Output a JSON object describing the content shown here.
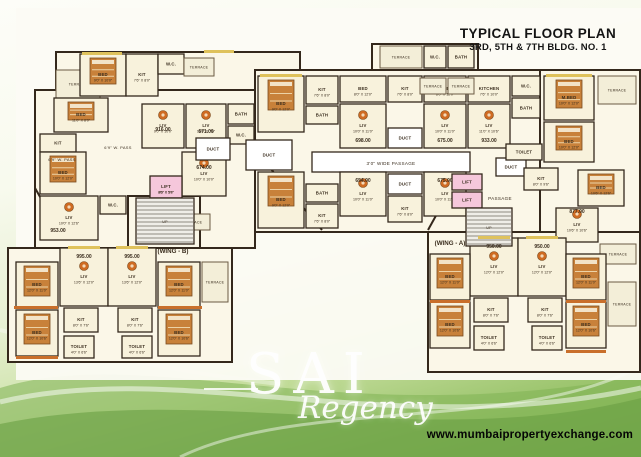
{
  "header": {
    "title": "TYPICAL FLOOR PLAN",
    "subtitle": "3RD, 5TH & 7TH BLDG. NO. 1"
  },
  "watermark": {
    "name": "SAI",
    "tagline": "Regency"
  },
  "footer": {
    "website": "www.mumbaipropertyexchange.com"
  },
  "plan": {
    "colors": {
      "wall": "#34281c",
      "paper": "#fbf7e8",
      "room": "#f8f2dc",
      "terrace": "#f3eed8",
      "terrace_stroke": "#6b5b43",
      "lift": "#f5c7db",
      "duct": "#ffffff",
      "stair": "#efede7",
      "stair_line": "#6f6a60",
      "bed_fill": "#c8813a",
      "bed_stroke": "#7a4a1e",
      "bed_line": "#ecd2a6",
      "table": "#cf6b22",
      "table_inner": "#f3d9b8",
      "sill_yellow": "#dfc25c",
      "sill_orange": "#c96f2b",
      "label": "#3a2d1e",
      "number": "#000000"
    },
    "blocks": [
      [
        56,
        52,
        244,
        98
      ],
      [
        35,
        90,
        220,
        158
      ],
      [
        255,
        70,
        385,
        162
      ],
      [
        540,
        70,
        100,
        178
      ],
      [
        372,
        44,
        106,
        26
      ],
      [
        8,
        248,
        224,
        114
      ],
      [
        428,
        232,
        212,
        140
      ],
      [
        128,
        196,
        72,
        52
      ]
    ],
    "diagonals": [
      [
        255,
        150,
        322,
        230
      ],
      [
        428,
        230,
        468,
        158
      ],
      [
        35,
        188,
        60,
        232
      ]
    ],
    "rooms": [
      {
        "x": 56,
        "y": 70,
        "w": 44,
        "h": 28,
        "t": "TERRACE",
        "f": "t"
      },
      {
        "x": 80,
        "y": 54,
        "w": 46,
        "h": 42,
        "t": "BED",
        "d": "9'0\" X 10'0\"",
        "fur": "bed"
      },
      {
        "x": 126,
        "y": 54,
        "w": 32,
        "h": 42,
        "t": "KIT",
        "d": "7'6\" X 8'0\""
      },
      {
        "x": 158,
        "y": 54,
        "w": 26,
        "h": 20,
        "t": "W.C."
      },
      {
        "x": 184,
        "y": 58,
        "w": 30,
        "h": 18,
        "t": "TERRACE",
        "f": "t"
      },
      {
        "x": 54,
        "y": 98,
        "w": 54,
        "h": 34,
        "t": "BED",
        "d": "11'0\" X 8'0\"",
        "fur": "bed"
      },
      {
        "x": 40,
        "y": 134,
        "w": 36,
        "h": 18,
        "t": "KIT"
      },
      {
        "x": 40,
        "y": 152,
        "w": 46,
        "h": 42,
        "t": "BED",
        "d": "10'0\" X 12'0\"",
        "fur": "bed"
      },
      {
        "x": 40,
        "y": 196,
        "w": 58,
        "h": 44,
        "t": "LIV",
        "d": "10'0\" X 12'6\"",
        "fur": "table"
      },
      {
        "x": 100,
        "y": 196,
        "w": 26,
        "h": 18,
        "t": "W.C."
      },
      {
        "x": 142,
        "y": 104,
        "w": 42,
        "h": 44,
        "t": "LIV",
        "d": "9'0\" X 10'0\"",
        "fur": "table"
      },
      {
        "x": 186,
        "y": 104,
        "w": 40,
        "h": 44,
        "t": "LIV",
        "d": "10'0\" X 7'6\"",
        "fur": "table"
      },
      {
        "x": 228,
        "y": 104,
        "w": 26,
        "h": 20,
        "t": "BATH"
      },
      {
        "x": 228,
        "y": 126,
        "w": 26,
        "h": 18,
        "t": "W.C."
      },
      {
        "x": 182,
        "y": 152,
        "w": 44,
        "h": 44,
        "t": "LIV",
        "d": "10'0\" X 10'0\"",
        "fur": "table"
      },
      {
        "x": 150,
        "y": 176,
        "w": 32,
        "h": 22,
        "t": "LIFT",
        "d": "8'6\" X 5'0\"",
        "f": "l"
      },
      {
        "x": 176,
        "y": 214,
        "w": 34,
        "h": 16,
        "t": "TERRACE",
        "f": "t"
      },
      {
        "x": 196,
        "y": 138,
        "w": 34,
        "h": 22,
        "t": "DUCT",
        "f": "d"
      },
      {
        "x": 246,
        "y": 140,
        "w": 46,
        "h": 30,
        "t": "DUCT",
        "f": "d"
      },
      {
        "x": 388,
        "y": 128,
        "w": 34,
        "h": 20,
        "t": "DUCT",
        "f": "d"
      },
      {
        "x": 388,
        "y": 174,
        "w": 34,
        "h": 20,
        "t": "DUCT",
        "f": "d"
      },
      {
        "x": 496,
        "y": 158,
        "w": 30,
        "h": 18,
        "t": "DUCT",
        "f": "d"
      },
      {
        "x": 312,
        "y": 152,
        "w": 158,
        "h": 20,
        "t": "",
        "f": "d"
      },
      {
        "x": 258,
        "y": 76,
        "w": 46,
        "h": 56,
        "t": "BED",
        "d": "9'0\" X 12'0\"",
        "fur": "bed"
      },
      {
        "x": 306,
        "y": 76,
        "w": 32,
        "h": 28,
        "t": "KIT",
        "d": "7'6\" X 8'0\""
      },
      {
        "x": 306,
        "y": 106,
        "w": 32,
        "h": 18,
        "t": "BATH"
      },
      {
        "x": 340,
        "y": 104,
        "w": 46,
        "h": 44,
        "t": "LIV",
        "d": "10'0\" X 11'0\"",
        "fur": "table"
      },
      {
        "x": 340,
        "y": 76,
        "w": 46,
        "h": 26,
        "t": "BED",
        "d": "8'0\" X 12'0\""
      },
      {
        "x": 388,
        "y": 76,
        "w": 34,
        "h": 26,
        "t": "KIT",
        "d": "7'6\" X 8'0\""
      },
      {
        "x": 424,
        "y": 104,
        "w": 42,
        "h": 44,
        "t": "LIV",
        "d": "10'0\" X 11'0\"",
        "fur": "table"
      },
      {
        "x": 424,
        "y": 76,
        "w": 42,
        "h": 26,
        "t": "BED",
        "d": "8'0\" X 12'0\""
      },
      {
        "x": 468,
        "y": 104,
        "w": 42,
        "h": 44,
        "t": "LIV",
        "d": "11'0\" X 10'6\"",
        "fur": "table"
      },
      {
        "x": 468,
        "y": 76,
        "w": 42,
        "h": 26,
        "t": "KITCHEN",
        "d": "7'6\" X 10'0\""
      },
      {
        "x": 512,
        "y": 76,
        "w": 28,
        "h": 20,
        "t": "W.C."
      },
      {
        "x": 512,
        "y": 98,
        "w": 28,
        "h": 20,
        "t": "BATH"
      },
      {
        "x": 544,
        "y": 76,
        "w": 50,
        "h": 44,
        "t": "M.BED",
        "d": "10'0\" X 12'0\"",
        "fur": "bed"
      },
      {
        "x": 544,
        "y": 122,
        "w": 50,
        "h": 40,
        "t": "BED",
        "d": "10'0\" X 12'0\"",
        "fur": "bed"
      },
      {
        "x": 506,
        "y": 144,
        "w": 36,
        "h": 16,
        "t": "TOILET"
      },
      {
        "x": 524,
        "y": 168,
        "w": 34,
        "h": 22,
        "t": "KIT",
        "d": "8'0\" X 9'6\""
      },
      {
        "x": 598,
        "y": 76,
        "w": 38,
        "h": 28,
        "t": "TERRACE",
        "f": "t"
      },
      {
        "x": 578,
        "y": 170,
        "w": 46,
        "h": 36,
        "t": "BED",
        "d": "10'6\" X 12'6\"",
        "fur": "bed"
      },
      {
        "x": 556,
        "y": 208,
        "w": 42,
        "h": 34,
        "t": "LIV",
        "d": "10'6\" X 10'6\"",
        "fur": "table"
      },
      {
        "x": 600,
        "y": 244,
        "w": 36,
        "h": 20,
        "t": "TERRACE",
        "f": "t"
      },
      {
        "x": 258,
        "y": 172,
        "w": 46,
        "h": 56,
        "t": "BED",
        "d": "9'0\" X 12'0\"",
        "fur": "bed"
      },
      {
        "x": 306,
        "y": 184,
        "w": 32,
        "h": 18,
        "t": "BATH"
      },
      {
        "x": 306,
        "y": 204,
        "w": 32,
        "h": 24,
        "t": "KIT",
        "d": "7'6\" X 8'0\""
      },
      {
        "x": 340,
        "y": 172,
        "w": 46,
        "h": 44,
        "t": "LIV",
        "d": "10'0\" X 11'0\"",
        "fur": "table"
      },
      {
        "x": 388,
        "y": 196,
        "w": 34,
        "h": 26,
        "t": "KIT",
        "d": "7'6\" X 8'0\""
      },
      {
        "x": 424,
        "y": 172,
        "w": 42,
        "h": 44,
        "t": "LIV",
        "d": "10'0\" X 11'0\"",
        "fur": "table"
      },
      {
        "x": 452,
        "y": 174,
        "w": 30,
        "h": 16,
        "t": "LIFT",
        "f": "l"
      },
      {
        "x": 452,
        "y": 192,
        "w": 30,
        "h": 16,
        "t": "LIFT",
        "f": "l"
      },
      {
        "x": 380,
        "y": 46,
        "w": 42,
        "h": 22,
        "t": "TERRACE",
        "f": "t"
      },
      {
        "x": 424,
        "y": 46,
        "w": 22,
        "h": 22,
        "t": "W.C."
      },
      {
        "x": 448,
        "y": 46,
        "w": 26,
        "h": 22,
        "t": "BATH"
      },
      {
        "x": 420,
        "y": 78,
        "w": 26,
        "h": 16,
        "t": "TERRACE",
        "f": "t"
      },
      {
        "x": 448,
        "y": 78,
        "w": 26,
        "h": 16,
        "t": "TERRACE",
        "f": "t"
      },
      {
        "x": 470,
        "y": 238,
        "w": 48,
        "h": 58,
        "t": "LIV",
        "d": "12'0\" X 12'0\"",
        "fur": "table"
      },
      {
        "x": 518,
        "y": 238,
        "w": 48,
        "h": 58,
        "t": "LIV",
        "d": "12'0\" X 12'0\"",
        "fur": "table"
      },
      {
        "x": 474,
        "y": 298,
        "w": 34,
        "h": 24,
        "t": "KIT",
        "d": "8'0\" X 7'6\""
      },
      {
        "x": 528,
        "y": 298,
        "w": 34,
        "h": 24,
        "t": "KIT",
        "d": "8'0\" X 7'6\""
      },
      {
        "x": 474,
        "y": 326,
        "w": 30,
        "h": 24,
        "t": "TOILET",
        "d": "4'0\" X 6'6\""
      },
      {
        "x": 532,
        "y": 326,
        "w": 30,
        "h": 24,
        "t": "TOILET",
        "d": "4'0\" X 6'6\""
      },
      {
        "x": 430,
        "y": 254,
        "w": 40,
        "h": 46,
        "t": "BED",
        "d": "12'0\" X 11'0\"",
        "fur": "bed"
      },
      {
        "x": 430,
        "y": 302,
        "w": 40,
        "h": 46,
        "t": "BED",
        "d": "12'0\" X 10'6\"",
        "fur": "bed"
      },
      {
        "x": 566,
        "y": 254,
        "w": 40,
        "h": 46,
        "t": "BED",
        "d": "12'0\" X 11'0\"",
        "fur": "bed"
      },
      {
        "x": 566,
        "y": 302,
        "w": 40,
        "h": 46,
        "t": "BED",
        "d": "12'0\" X 10'6\"",
        "fur": "bed"
      },
      {
        "x": 608,
        "y": 282,
        "w": 28,
        "h": 44,
        "t": "TERRACE",
        "f": "t"
      },
      {
        "x": 60,
        "y": 248,
        "w": 48,
        "h": 58,
        "t": "LIV",
        "d": "13'6\" X 12'0\"",
        "fur": "table"
      },
      {
        "x": 108,
        "y": 248,
        "w": 48,
        "h": 58,
        "t": "LIV",
        "d": "13'6\" X 12'0\"",
        "fur": "table"
      },
      {
        "x": 64,
        "y": 308,
        "w": 34,
        "h": 24,
        "t": "KIT",
        "d": "8'0\" X 7'6\""
      },
      {
        "x": 118,
        "y": 308,
        "w": 34,
        "h": 24,
        "t": "KIT",
        "d": "8'0\" X 7'6\""
      },
      {
        "x": 64,
        "y": 336,
        "w": 30,
        "h": 22,
        "t": "TOILET",
        "d": "4'0\" X 6'6\""
      },
      {
        "x": 122,
        "y": 336,
        "w": 30,
        "h": 22,
        "t": "TOILET",
        "d": "4'0\" X 6'6\""
      },
      {
        "x": 16,
        "y": 262,
        "w": 42,
        "h": 46,
        "t": "BED",
        "d": "12'0\" X 11'0\"",
        "fur": "bed"
      },
      {
        "x": 16,
        "y": 310,
        "w": 42,
        "h": 46,
        "t": "BED",
        "d": "12'0\" X 10'6\"",
        "fur": "bed"
      },
      {
        "x": 158,
        "y": 262,
        "w": 42,
        "h": 46,
        "t": "BED",
        "d": "12'0\" X 11'0\"",
        "fur": "bed"
      },
      {
        "x": 158,
        "y": 310,
        "w": 42,
        "h": 46,
        "t": "BED",
        "d": "12'0\" X 10'6\"",
        "fur": "bed"
      },
      {
        "x": 202,
        "y": 262,
        "w": 26,
        "h": 40,
        "t": "TERRACE",
        "f": "t"
      }
    ],
    "stairs": [
      [
        136,
        198,
        58,
        46
      ],
      [
        466,
        208,
        46,
        38
      ]
    ],
    "unit_areas": [
      {
        "v": "916.00",
        "x": 163,
        "y": 131
      },
      {
        "v": "671.00",
        "x": 206,
        "y": 133
      },
      {
        "v": "674.00",
        "x": 204,
        "y": 169
      },
      {
        "v": "698.00",
        "x": 363,
        "y": 142
      },
      {
        "v": "654.00",
        "x": 363,
        "y": 182
      },
      {
        "v": "675.00",
        "x": 445,
        "y": 142
      },
      {
        "v": "933.00",
        "x": 489,
        "y": 142
      },
      {
        "v": "675.00",
        "x": 445,
        "y": 182
      },
      {
        "v": "877.00",
        "x": 577,
        "y": 213
      },
      {
        "v": "953.00",
        "x": 58,
        "y": 232
      },
      {
        "v": "995.00",
        "x": 84,
        "y": 258
      },
      {
        "v": "995.00",
        "x": 132,
        "y": 258
      },
      {
        "v": "950.00",
        "x": 494,
        "y": 248
      },
      {
        "v": "950.00",
        "x": 542,
        "y": 248
      }
    ],
    "corridors": [
      {
        "t": "3'0\" WIDE PASSAGE",
        "x": 391,
        "y": 165,
        "s": 4.6
      },
      {
        "t": "PASSAGE",
        "x": 500,
        "y": 200,
        "s": 4.6
      },
      {
        "t": "6'9\" W. PASS",
        "x": 118,
        "y": 149,
        "s": 4
      },
      {
        "t": "6'9\" W. PASS",
        "x": 62,
        "y": 161,
        "s": 4
      },
      {
        "t": "UP",
        "x": 165,
        "y": 223,
        "s": 3.6
      },
      {
        "t": "UP",
        "x": 489,
        "y": 229,
        "s": 3.6
      }
    ],
    "wing_labels": [
      {
        "t": "(WING - B)",
        "x": 173,
        "y": 253
      },
      {
        "t": "(WING - A)",
        "x": 450,
        "y": 245
      }
    ],
    "sills": [
      [
        82,
        52,
        40,
        3,
        "y"
      ],
      [
        260,
        74,
        42,
        3,
        "y"
      ],
      [
        546,
        74,
        46,
        3,
        "y"
      ],
      [
        68,
        246,
        32,
        3,
        "y"
      ],
      [
        116,
        246,
        32,
        3,
        "y"
      ],
      [
        478,
        236,
        32,
        3,
        "y"
      ],
      [
        526,
        236,
        32,
        3,
        "y"
      ],
      [
        14,
        306,
        44,
        3,
        "o"
      ],
      [
        158,
        306,
        44,
        3,
        "o"
      ],
      [
        430,
        300,
        40,
        3,
        "o"
      ],
      [
        566,
        300,
        40,
        3,
        "o"
      ],
      [
        16,
        356,
        42,
        3,
        "o"
      ],
      [
        566,
        350,
        40,
        3,
        "o"
      ],
      [
        204,
        50,
        30,
        3,
        "y"
      ]
    ]
  },
  "background": {
    "waves": [
      {
        "d": "M0,388 C150,342 330,432 641,376 L641,457 L0,457 Z",
        "fill": "#7fb254",
        "opacity": 0.55
      },
      {
        "d": "M0,424 C200,382 430,452 641,398 L641,457 L0,457 Z",
        "fill": "#699f43",
        "opacity": 0.6
      },
      {
        "d": "M0,402 C180,358 390,442 641,388",
        "stroke": "#ffffff",
        "width": 5,
        "opacity": 0.5
      },
      {
        "d": "M180,457 C300,398 520,432 641,366",
        "stroke": "#ffffff",
        "width": 3,
        "opacity": 0.45
      },
      {
        "d": "M0,330 C90,352 170,372 280,384",
        "stroke": "#ffffff",
        "width": 4,
        "opacity": 0.35
      }
    ],
    "panel": {
      "x": 16,
      "y": 8,
      "w": 625,
      "h": 372,
      "fill": "#fcfbf4",
      "opacity": 0.95
    }
  }
}
